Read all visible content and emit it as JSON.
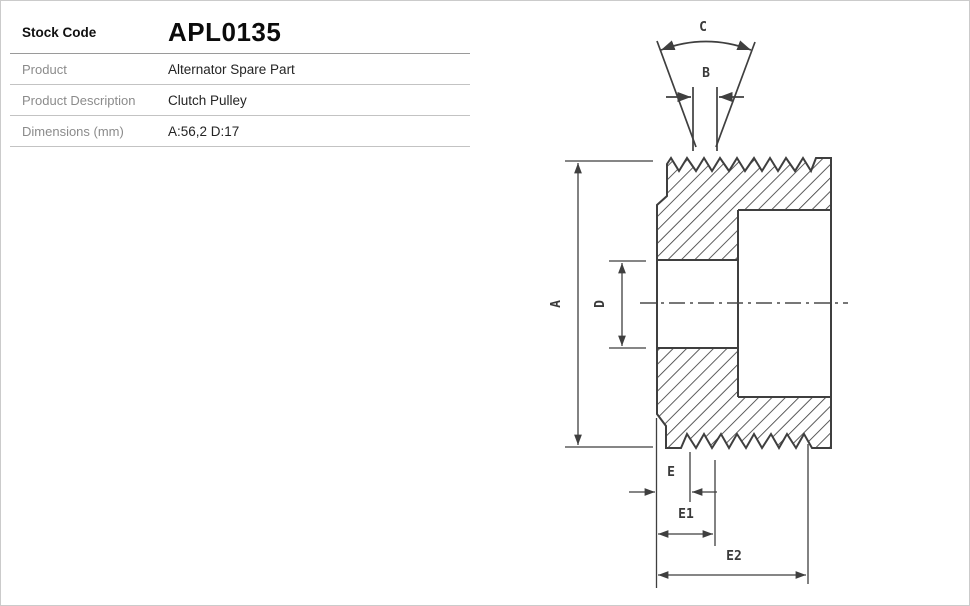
{
  "page": {
    "background": "#ffffff",
    "border_color": "#cbcbcb"
  },
  "spec_table": {
    "rows": [
      {
        "label": "Stock Code",
        "value": "APL0135"
      },
      {
        "label": "Product",
        "value": "Alternator Spare Part"
      },
      {
        "label": "Product Description",
        "value": "Clutch Pulley"
      },
      {
        "label": "Dimensions (mm)",
        "value": "A:56,2 D:17"
      }
    ]
  },
  "drawing": {
    "line_color": "#3f3f3f",
    "labels": {
      "groove_angle": "C",
      "groove_width": "B",
      "outer_diameter": "A",
      "bore_diameter": "D",
      "offset_e": "E",
      "offset_e1": "E1",
      "offset_e2": "E2"
    }
  }
}
